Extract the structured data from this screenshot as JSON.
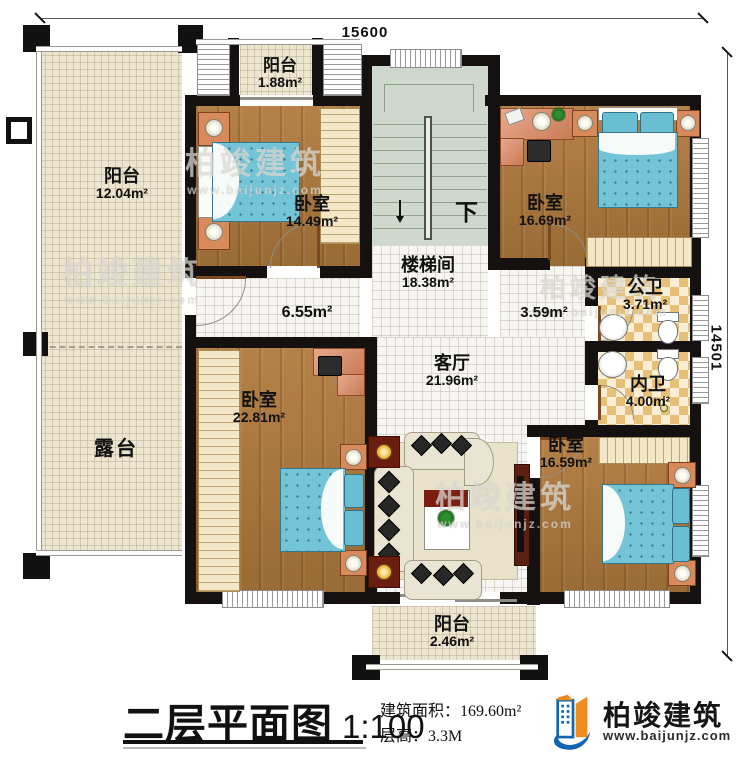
{
  "plan": {
    "dimensions": {
      "top": "15600",
      "right": "14501"
    },
    "stair": {
      "down_label": "下"
    },
    "rooms": {
      "balcony_top": {
        "name": "阳台",
        "area": "1.88m²"
      },
      "balcony_left": {
        "name": "阳台",
        "area": "12.04m²"
      },
      "bedroom_nw": {
        "name": "卧室",
        "area": "14.49m²"
      },
      "bedroom_ne": {
        "name": "卧室",
        "area": "16.69m²"
      },
      "stairwell": {
        "name": "楼梯间",
        "area": "18.38m²"
      },
      "hall": {
        "area": "6.55m²"
      },
      "corridor": {
        "area": "3.59m²"
      },
      "bath_public": {
        "name": "公卫",
        "area": "3.71m²"
      },
      "bath_inner": {
        "name": "内卫",
        "area": "4.00m²"
      },
      "living": {
        "name": "客厅",
        "area": "21.96m²"
      },
      "bedroom_sw": {
        "name": "卧室",
        "area": "22.81m²"
      },
      "bedroom_se": {
        "name": "卧室",
        "area": "16.59m²"
      },
      "terrace": {
        "name": "露台"
      },
      "balcony_bottom": {
        "name": "阳台",
        "area": "2.46m²"
      }
    }
  },
  "title_block": {
    "title": "二层平面图",
    "scale": "1:100",
    "area_label": "建筑面积：",
    "area_value": "169.60m²",
    "height_label": "层高：",
    "height_value": "3.3M"
  },
  "brand": {
    "name": "柏竣建筑",
    "website": "www.baijunjz.com"
  }
}
